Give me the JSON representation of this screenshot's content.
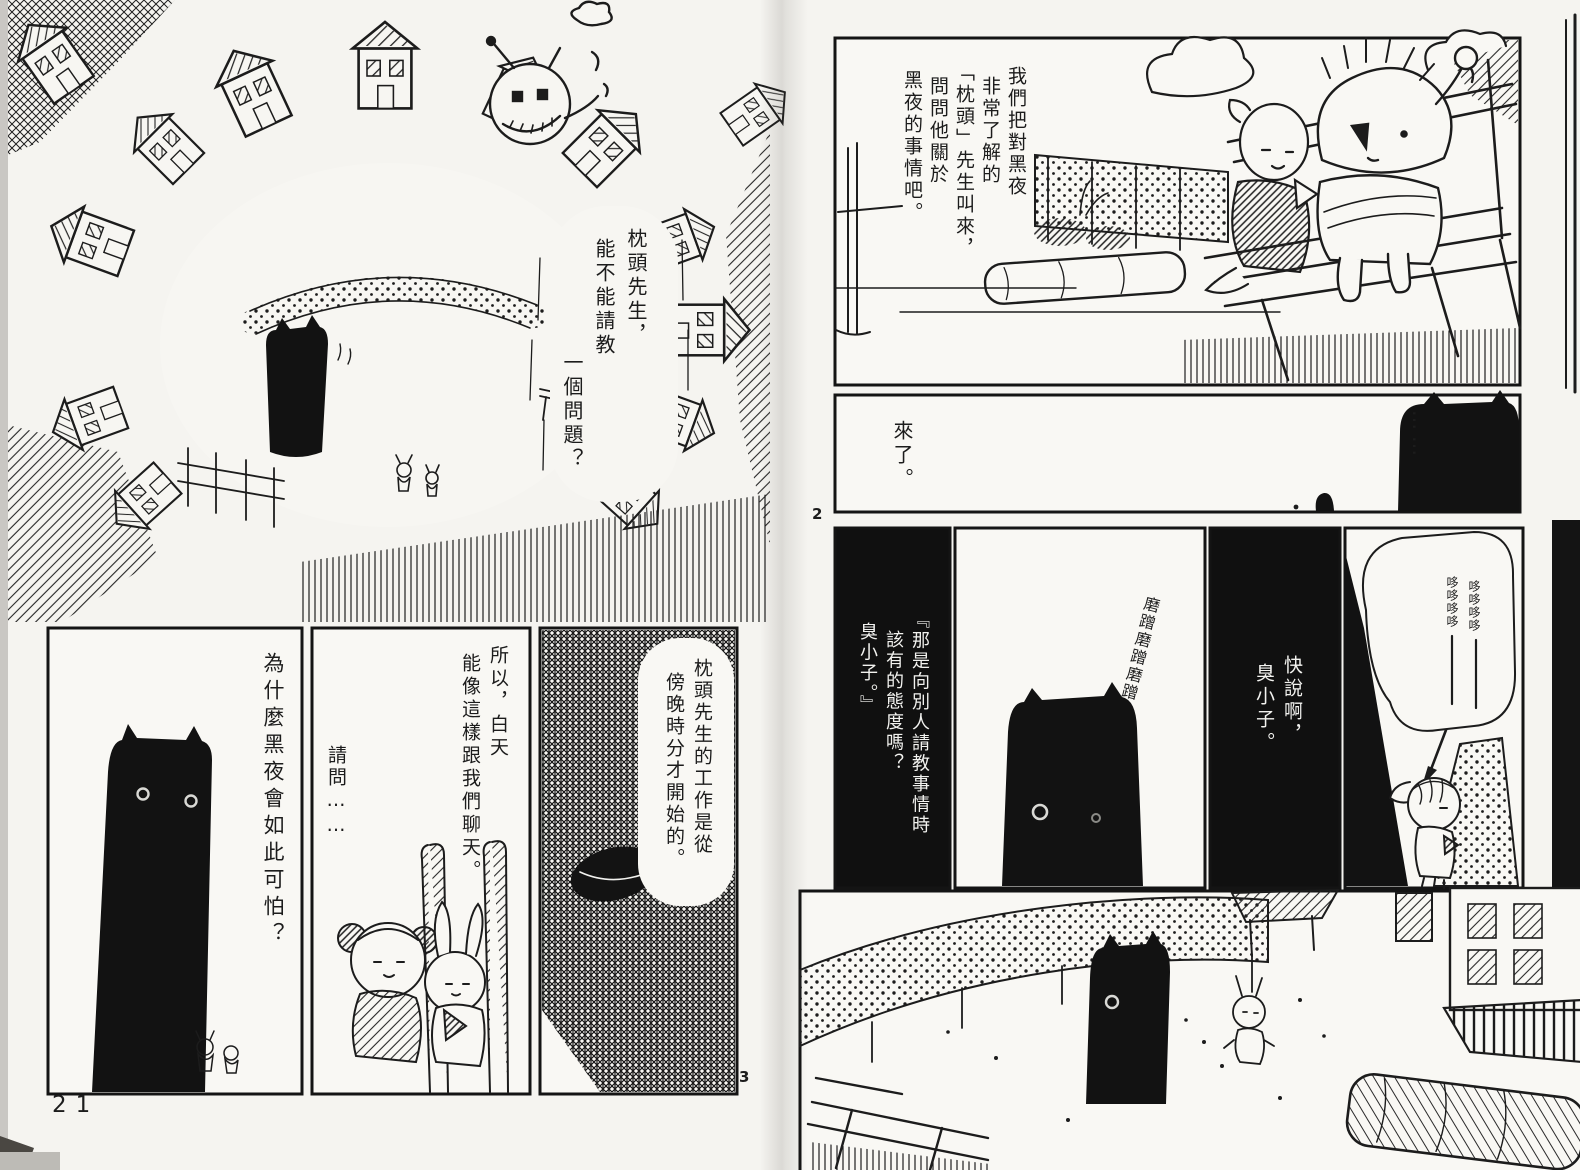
{
  "left_page": {
    "page_number": "21",
    "panel_marker": "3",
    "bubble": {
      "cols": [
        "枕頭先生，",
        "能不能請教",
        "一個問題？"
      ]
    },
    "panel_creature": {
      "line": "為什麼黑夜會如此可怕？"
    },
    "panel_middle": {
      "cols": [
        "所以，白天",
        "能像這樣跟我們聊天。"
      ],
      "aside": "請問……"
    },
    "panel_dark": {
      "cols": [
        "枕頭先生的工作是從",
        "傍晚時分才開始的。"
      ]
    }
  },
  "right_page": {
    "panel_marker": "2",
    "panel_top": {
      "cols": [
        "我們把對黑夜",
        "非常了解的",
        "「枕頭」先生叫來，",
        "問問他關於",
        "黑夜的事情吧。"
      ]
    },
    "panel_came": {
      "line": "來了。",
      "ellipsis": "……"
    },
    "panel_scold": {
      "cols": [
        "『那是向別人請教事情時",
        "該有的態度嗎？",
        "臭小子。』"
      ]
    },
    "sfx_rub": "磨蹭磨蹭磨蹭",
    "panel_hurry": {
      "cols": [
        "快說啊，",
        "臭小子。"
      ]
    },
    "sfx_shiver": {
      "cols": [
        "哆哆哆哆",
        "哆哆哆哆"
      ]
    }
  },
  "colors": {
    "ink": "#1c1c1c",
    "paper": "#f7f6f2"
  }
}
